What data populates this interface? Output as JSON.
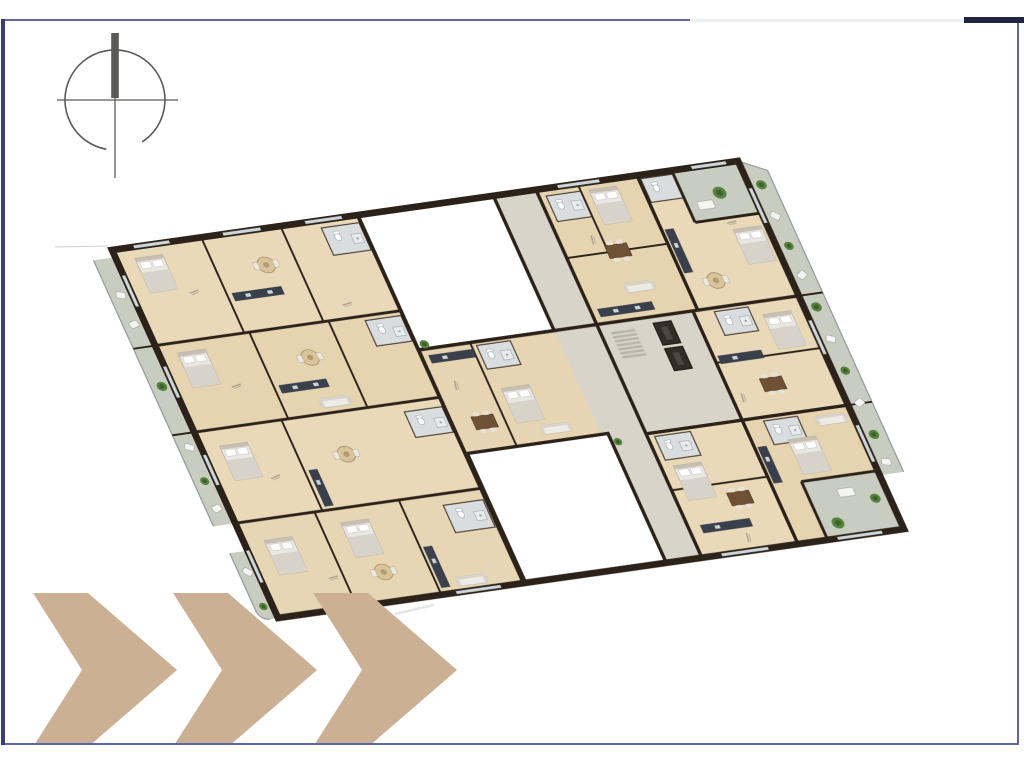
{
  "colors": {
    "page-bg": "#ffffff",
    "frame-border": "#6064a8",
    "frame-border-left": "#3a3f6d",
    "frame-accent": "#20243f",
    "frame-light-segment": "#eef0f2",
    "compass": "#5a5a57",
    "chevron": "#cbb094",
    "wall": "#2b221a",
    "wood": "#ead9b8",
    "wood-dark": "#dcc49c",
    "corridor": "#d8d4ca",
    "balcony": "#c9cdc1",
    "railing": "#9aa0a0",
    "courtyard": "#ffffff",
    "plant": "#55823e",
    "plant-dark": "#3c6129",
    "bed": "#e9e7e3",
    "bed-blanket": "#d7d3cb",
    "kitchen": "#39404c",
    "table": "#6f5236",
    "bath": "#dadddd",
    "fixture": "#ffffff",
    "window": "#cdd6d8",
    "dim-mark": "#6b6b6b"
  },
  "compass": {
    "icon": "north-compass-icon"
  },
  "floor_plan": {
    "kind": "3d-rendered residential floor plate, rotated, furnished apartment units",
    "courtyards": 2,
    "perimeter_balconies": [
      "left",
      "right",
      "top-right-terrace",
      "bottom-right-terrace",
      "bottom-left"
    ],
    "dimension_labels_legible": false
  },
  "decoration": {
    "chevrons": {
      "count": 3,
      "direction": "right"
    }
  }
}
